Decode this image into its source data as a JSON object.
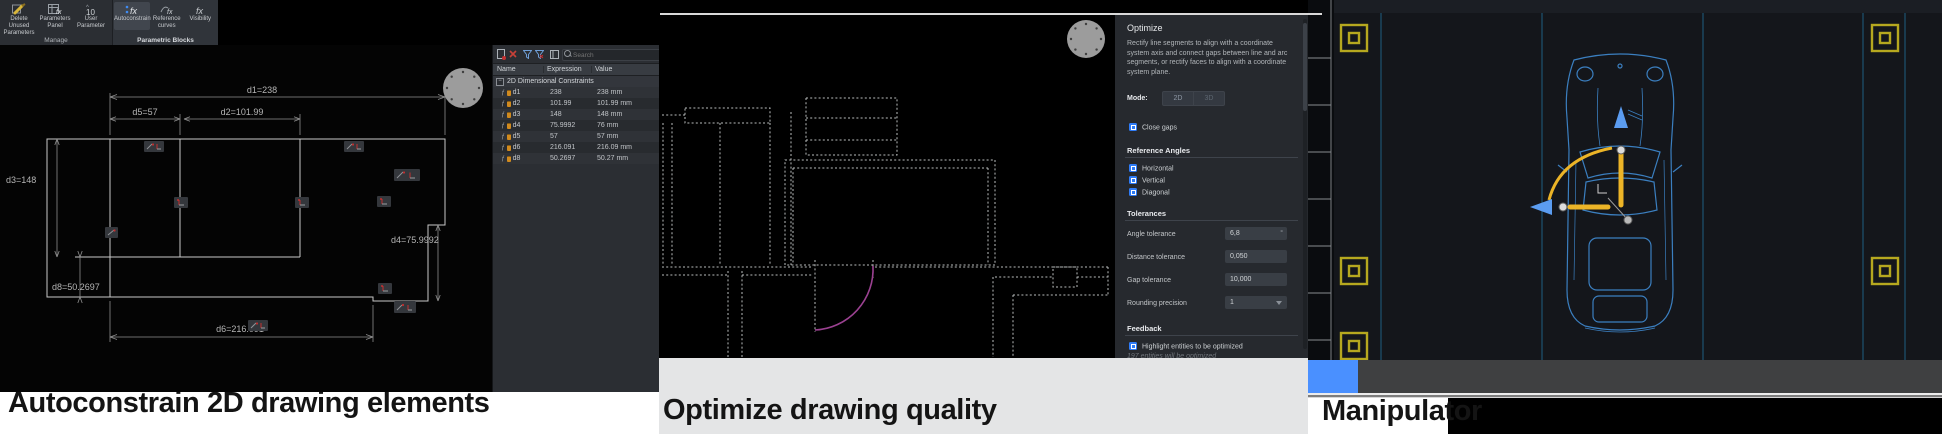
{
  "captions": {
    "left": "Autoconstrain 2D drawing elements",
    "middle": "Optimize drawing quality",
    "right": "Manipulator"
  },
  "ribbon": {
    "groups": [
      {
        "label": "Manage",
        "buttons": [
          {
            "line1": "Delete Unused",
            "line2": "Parameters"
          },
          {
            "line1": "Parameters",
            "line2": "Panel"
          },
          {
            "line1": "User",
            "line2": "Parameter"
          }
        ]
      },
      {
        "label": "Parametric Blocks",
        "buttons": [
          {
            "line1": "Autoconstrain",
            "line2": ""
          },
          {
            "line1": "Reference",
            "line2": "curves"
          },
          {
            "line1": "Visibility",
            "line2": ""
          }
        ]
      }
    ]
  },
  "drawing": {
    "dims": {
      "d1": "d1=238",
      "d5": "d5=57",
      "d2": "d2=101.99",
      "d3": "d3=148",
      "d8": "d8=50.2697",
      "d4": "d4=75.9992",
      "d6": "d6=216.091"
    }
  },
  "params_panel": {
    "search_placeholder": "Search",
    "columns": [
      "Name",
      "Expression",
      "Value"
    ],
    "group": "2D Dimensional Constraints",
    "rows": [
      {
        "name": "d1",
        "expression": "238",
        "value": "238 mm"
      },
      {
        "name": "d2",
        "expression": "101.99",
        "value": "101.99 mm"
      },
      {
        "name": "d3",
        "expression": "148",
        "value": "148 mm"
      },
      {
        "name": "d4",
        "expression": "75.9992",
        "value": "76 mm"
      },
      {
        "name": "d5",
        "expression": "57",
        "value": "57 mm"
      },
      {
        "name": "d6",
        "expression": "216.091",
        "value": "216.09 mm"
      },
      {
        "name": "d8",
        "expression": "50.2697",
        "value": "50.27 mm"
      }
    ]
  },
  "optimize": {
    "title": "Optimize",
    "description": "Rectify line segments to align with a coordinate system axis and connect gaps between line and arc segments, or rectify faces to align with a coordinate system plane.",
    "mode_label": "Mode:",
    "modes": [
      "2D",
      "3D"
    ],
    "close_gaps": "Close gaps",
    "reference_heading": "Reference Angles",
    "reference_options": [
      "Horizontal",
      "Vertical",
      "Diagonal"
    ],
    "tolerances_heading": "Tolerances",
    "fields": [
      {
        "label": "Angle tolerance",
        "value": "6,8",
        "unit": "°"
      },
      {
        "label": "Distance tolerance",
        "value": "0,050",
        "unit": ""
      },
      {
        "label": "Gap tolerance",
        "value": "10,000",
        "unit": ""
      },
      {
        "label": "Rounding precision",
        "value": "1",
        "unit": ""
      }
    ],
    "feedback_heading": "Feedback",
    "highlight_label": "Highlight entities to be optimized",
    "feedback_note": "197 entities will be optimized"
  },
  "colors": {
    "accent_blue": "#2e7bf6",
    "progress_blue": "#4a90ff",
    "cad_yellow": "#b6a81f",
    "manipulator_yellow": "#ecb427",
    "car_blue": "#3b7fc0",
    "door_magenta": "#9b4191"
  }
}
